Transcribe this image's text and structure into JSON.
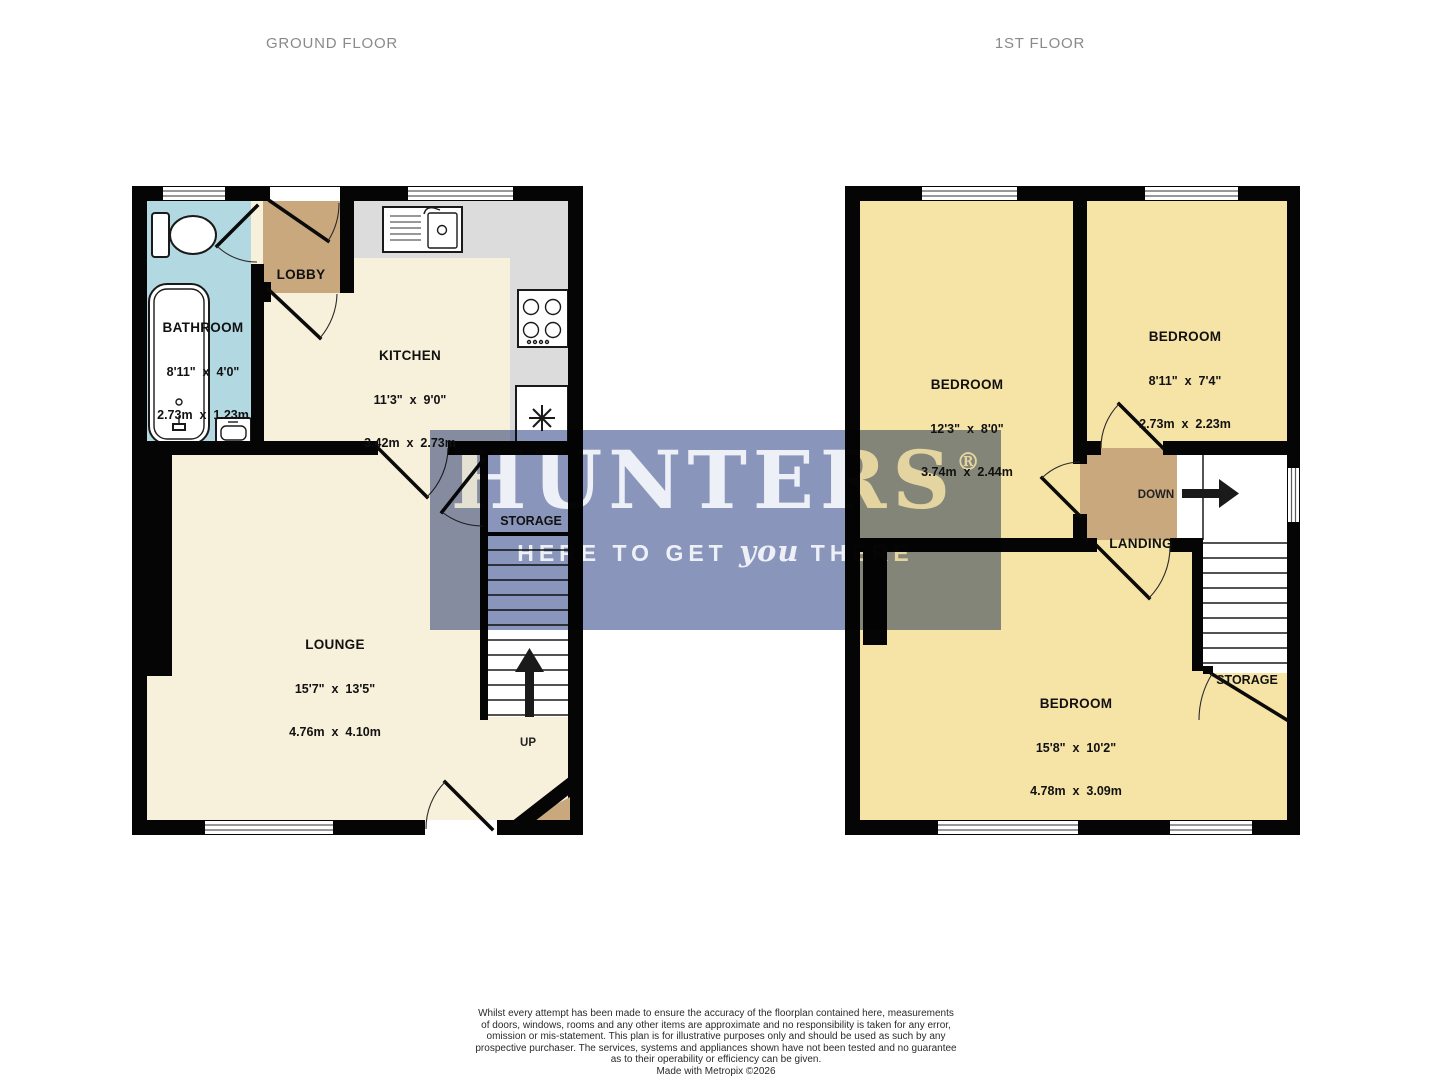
{
  "titles": {
    "ground": "GROUND FLOOR",
    "first": "1ST FLOOR"
  },
  "watermark": {
    "brand": "HUNTERS",
    "registered": "®",
    "tagline_pre": "HERE TO GET ",
    "tagline_emph": "you",
    "tagline_post": " THERE"
  },
  "ground_floor": {
    "bathroom": {
      "name": "BATHROOM",
      "imperial": "8'11\"  x  4'0\"",
      "metric": "2.73m  x  1.23m"
    },
    "lobby": {
      "name": "LOBBY"
    },
    "kitchen": {
      "name": "KITCHEN",
      "imperial": "11'3\"  x  9'0\"",
      "metric": "3.42m  x  2.73m"
    },
    "lounge": {
      "name": "LOUNGE",
      "imperial": "15'7\"  x  13'5\"",
      "metric": "4.76m  x  4.10m"
    },
    "storage": {
      "name": "STORAGE"
    },
    "stairs_label": "UP"
  },
  "first_floor": {
    "bedroom1": {
      "name": "BEDROOM",
      "imperial": "12'3\"  x  8'0\"",
      "metric": "3.74m  x  2.44m"
    },
    "bedroom2": {
      "name": "BEDROOM",
      "imperial": "8'11\"  x  7'4\"",
      "metric": "2.73m  x  2.23m"
    },
    "bedroom3": {
      "name": "BEDROOM",
      "imperial": "15'8\"  x  10'2\"",
      "metric": "4.78m  x  3.09m"
    },
    "landing": {
      "name": "LANDING"
    },
    "storage": {
      "name": "STORAGE"
    },
    "stairs_label": "DOWN"
  },
  "footer": {
    "disclaimer_lines": [
      "Whilst every attempt has been made to ensure the accuracy of the floorplan contained here, measurements",
      "of doors, windows, rooms and any other items are approximate and no responsibility is taken for any error,",
      "omission or mis-statement. This plan is for illustrative purposes only and should be used as such by any",
      "prospective purchaser. The services, systems and appliances shown have not been tested and no guarantee",
      "as to their operability or efficiency can be given.",
      "Made with Metropix ©2026"
    ]
  },
  "colors": {
    "wall": "#050505",
    "floor_ground": "#f7f0da",
    "floor_first": "#f6e3a6",
    "bathroom": "#b2d9e2",
    "tan": "#c9a87e",
    "counter": "#dcdcdc",
    "stairs": "#ffffff",
    "watermark": "#8995ba",
    "title": "#8a8a8a",
    "label": "#111111"
  }
}
